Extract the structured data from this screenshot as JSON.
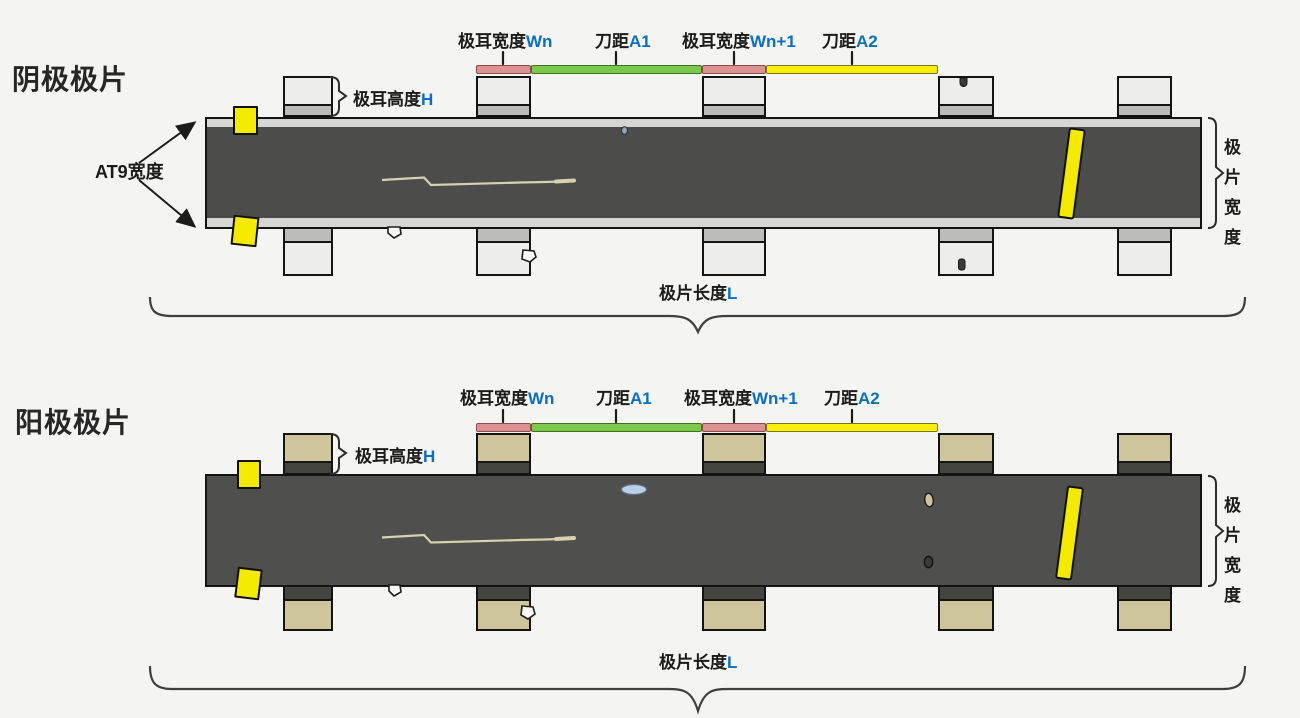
{
  "page": {
    "background": "#f4f4f2"
  },
  "labels": {
    "tab_width_n": {
      "text": "极耳宽度",
      "var": "Wn"
    },
    "knife_a1": {
      "text": "刀距",
      "var": "A1"
    },
    "tab_width_n1": {
      "text": "极耳宽度",
      "var": "Wn+1"
    },
    "knife_a2": {
      "text": "刀距",
      "var": "A2"
    },
    "tab_height": {
      "text": "极耳高度",
      "var": "H"
    },
    "sheet_length": {
      "text": "极片长度",
      "var": "L"
    },
    "sheet_width": {
      "chars": [
        "极",
        "片",
        "宽",
        "度"
      ]
    }
  },
  "cathode": {
    "title": "阴极极片",
    "at9_label": "AT9宽度"
  },
  "anode": {
    "title": "阳极极片"
  },
  "colors": {
    "cathode_strip": "#4c4c4a",
    "cathode_strip_edge": "#d6d6d4",
    "cathode_tab": "#ededeb",
    "cathode_tab_band": "#bcbcba",
    "anode_strip": "#4f4f4d",
    "anode_tab": "#cec59c",
    "anode_tab_band": "#45453f",
    "tab_width_bar": "#db9392",
    "knife_a1_bar": "#7cc84d",
    "knife_a2_bar": "#f8f000",
    "defect_mark_yellow": "#f4ea00",
    "annotation_blue": "#0a6fc2"
  }
}
